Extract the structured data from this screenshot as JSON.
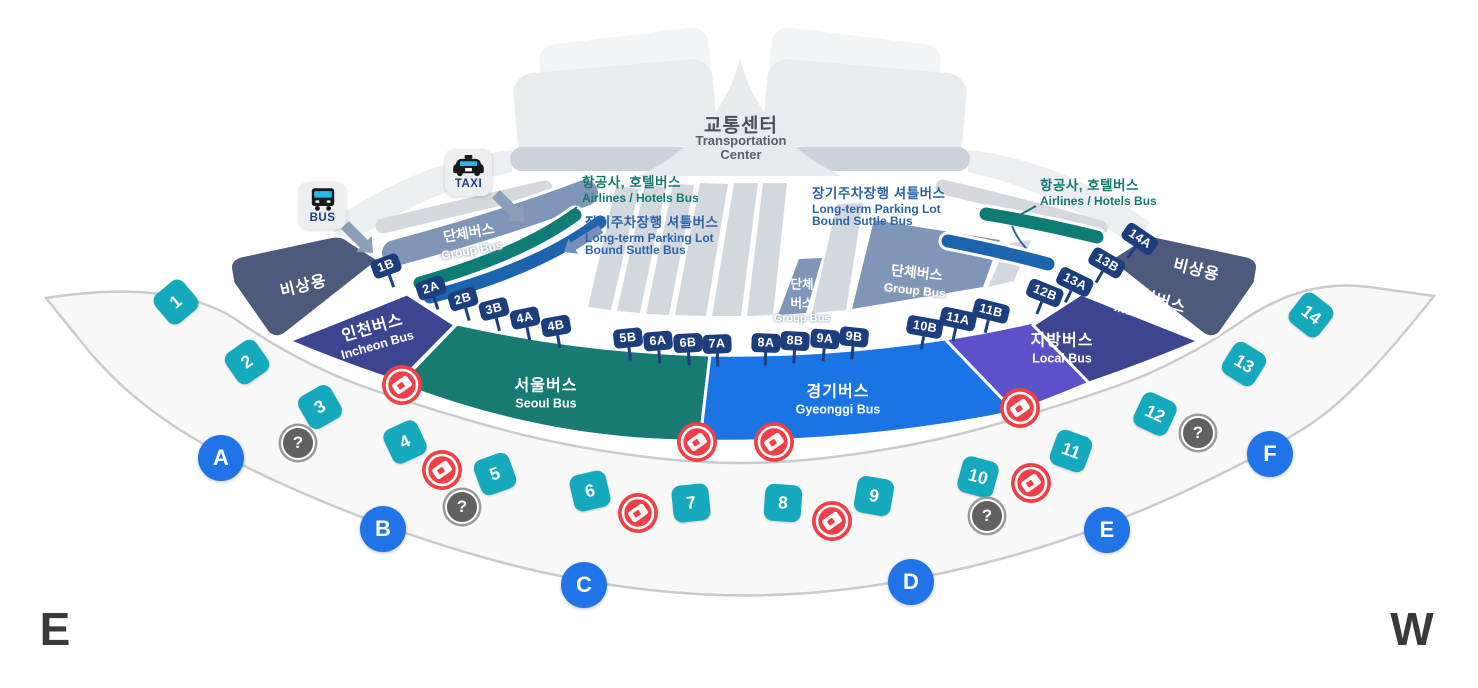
{
  "title": {
    "ko": "교통센터",
    "en1": "Transportation",
    "en2": "Center"
  },
  "compass": {
    "east": "E",
    "west": "W"
  },
  "facilities": {
    "bus_label": "BUS",
    "taxi_label": "TAXI"
  },
  "callouts": {
    "airlines_left": {
      "ko": "항공사, 호텔버스",
      "en": "Airlines / Hotels Bus"
    },
    "longterm_left": {
      "ko": "장기주차장행 셔틀버스",
      "en1": "Long-term Parking Lot",
      "en2": "Bound Suttle Bus"
    },
    "longterm_right": {
      "ko": "장기주차장행 셔틀버스",
      "en1": "Long-term Parking Lot",
      "en2": "Bound Suttle Bus"
    },
    "airlines_right": {
      "ko": "항공사, 호텔버스",
      "en": "Airlines / Hotels Bus"
    }
  },
  "zones": {
    "emergency_left": {
      "ko": "비상용"
    },
    "incheon_left": {
      "ko": "인천버스",
      "en": "Incheon Bus"
    },
    "seoul": {
      "ko": "서울버스",
      "en": "Seoul Bus"
    },
    "gyeonggi": {
      "ko": "경기버스",
      "en": "Gyeonggi Bus"
    },
    "local": {
      "ko": "지방버스",
      "en": "Local Bus"
    },
    "incheon_right": {
      "ko": "인천버스",
      "en": "Incheon Bus"
    },
    "emergency_right": {
      "ko": "비상용"
    },
    "group_left": {
      "ko": "단체버스",
      "en": "Group Bus"
    },
    "group_mid": {
      "ko1": "단체",
      "ko2": "버스",
      "en": "Group Bus"
    },
    "group_right": {
      "ko": "단체버스",
      "en": "Group Bus"
    }
  },
  "gates": [
    {
      "label": "1B",
      "x": 386,
      "y": 266,
      "rot": -20
    },
    {
      "label": "2A",
      "x": 431,
      "y": 288,
      "rot": -18
    },
    {
      "label": "2B",
      "x": 463,
      "y": 299,
      "rot": -16
    },
    {
      "label": "3B",
      "x": 494,
      "y": 309,
      "rot": -14
    },
    {
      "label": "4A",
      "x": 525,
      "y": 318,
      "rot": -12
    },
    {
      "label": "4B",
      "x": 556,
      "y": 326,
      "rot": -10
    },
    {
      "label": "5B",
      "x": 628,
      "y": 338,
      "rot": -6
    },
    {
      "label": "6A",
      "x": 658,
      "y": 341,
      "rot": -5
    },
    {
      "label": "6B",
      "x": 688,
      "y": 343,
      "rot": -3
    },
    {
      "label": "7A",
      "x": 717,
      "y": 344,
      "rot": -2
    },
    {
      "label": "8A",
      "x": 766,
      "y": 343,
      "rot": 2
    },
    {
      "label": "8B",
      "x": 795,
      "y": 341,
      "rot": 3
    },
    {
      "label": "9A",
      "x": 825,
      "y": 339,
      "rot": 5
    },
    {
      "label": "9B",
      "x": 854,
      "y": 337,
      "rot": 6
    },
    {
      "label": "10B",
      "x": 925,
      "y": 327,
      "rot": 10
    },
    {
      "label": "11A",
      "x": 958,
      "y": 319,
      "rot": 12
    },
    {
      "label": "11B",
      "x": 991,
      "y": 311,
      "rot": 14
    },
    {
      "label": "12B",
      "x": 1045,
      "y": 293,
      "rot": 22
    },
    {
      "label": "13A",
      "x": 1075,
      "y": 282,
      "rot": 26
    },
    {
      "label": "13B",
      "x": 1107,
      "y": 263,
      "rot": 30
    },
    {
      "label": "14A",
      "x": 1140,
      "y": 239,
      "rot": 34
    }
  ],
  "stops": [
    {
      "label": "1",
      "x": 176,
      "y": 302,
      "rot": -40
    },
    {
      "label": "2",
      "x": 247,
      "y": 362,
      "rot": -35
    },
    {
      "label": "3",
      "x": 320,
      "y": 407,
      "rot": -30
    },
    {
      "label": "4",
      "x": 405,
      "y": 442,
      "rot": -25
    },
    {
      "label": "5",
      "x": 495,
      "y": 474,
      "rot": -20
    },
    {
      "label": "6",
      "x": 590,
      "y": 491,
      "rot": -13
    },
    {
      "label": "7",
      "x": 691,
      "y": 503,
      "rot": -6
    },
    {
      "label": "8",
      "x": 783,
      "y": 503,
      "rot": 4
    },
    {
      "label": "9",
      "x": 874,
      "y": 496,
      "rot": 10
    },
    {
      "label": "10",
      "x": 978,
      "y": 477,
      "rot": 15
    },
    {
      "label": "11",
      "x": 1071,
      "y": 451,
      "rot": 20
    },
    {
      "label": "12",
      "x": 1155,
      "y": 414,
      "rot": 25
    },
    {
      "label": "13",
      "x": 1244,
      "y": 364,
      "rot": 32
    },
    {
      "label": "14",
      "x": 1311,
      "y": 315,
      "rot": 38
    }
  ],
  "doors": [
    {
      "label": "A",
      "x": 221,
      "y": 458
    },
    {
      "label": "B",
      "x": 383,
      "y": 529
    },
    {
      "label": "C",
      "x": 584,
      "y": 585
    },
    {
      "label": "D",
      "x": 911,
      "y": 582
    },
    {
      "label": "E",
      "x": 1107,
      "y": 530
    },
    {
      "label": "F",
      "x": 1270,
      "y": 454
    }
  ],
  "info_points": [
    {
      "x": 298,
      "y": 443
    },
    {
      "x": 462,
      "y": 507
    },
    {
      "x": 987,
      "y": 516
    },
    {
      "x": 1198,
      "y": 433
    }
  ],
  "ticket_booths": [
    {
      "x": 402,
      "y": 385
    },
    {
      "x": 442,
      "y": 470
    },
    {
      "x": 638,
      "y": 513
    },
    {
      "x": 697,
      "y": 442
    },
    {
      "x": 774,
      "y": 442
    },
    {
      "x": 832,
      "y": 521
    },
    {
      "x": 1020,
      "y": 408
    },
    {
      "x": 1031,
      "y": 483
    }
  ],
  "markers": {
    "info_glyph": "?"
  },
  "colors": {
    "emergency": "#4E5A7C",
    "incheon": "#3D4591",
    "seoul": "#177A73",
    "gyeonggi": "#1A74E4",
    "local": "#5B51C9",
    "group": "#8096B8",
    "lane_teal": "#107C76",
    "lane_blue": "#1D64AE",
    "lane_gray": "#D3D7DE",
    "stop_cyan": "#14A9BD",
    "door_blue": "#2173E8",
    "gate_navy": "#1D3E7D",
    "ticket_red": "#EE4046",
    "info_gray": "#616161",
    "band_fill": "#F8F8F9",
    "band_stroke": "#C9CBCE",
    "callout_teal": "#15786E",
    "callout_blue": "#2B63A8",
    "arrow": "#8BA0B8"
  }
}
